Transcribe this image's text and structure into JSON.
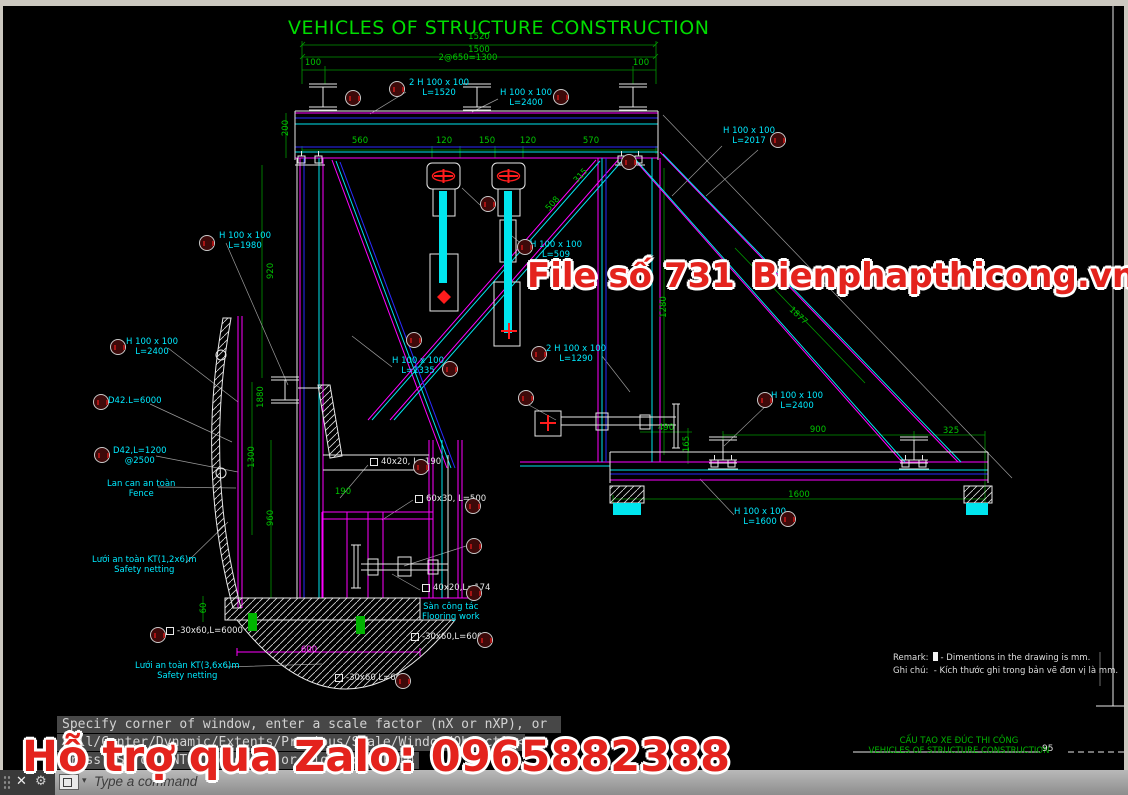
{
  "title": "VEHICLES OF STRUCTURE CONSTRUCTION",
  "watermarks": {
    "file_no": "File số 731",
    "site": "Bienphapthicong.vn",
    "zalo": "Hỗ trợ qua Zalo: 0965882388"
  },
  "remark": {
    "en_label": "Remark:",
    "en": "- Dimentions in the drawing is mm.",
    "vn_label": "Ghi chú:",
    "vn": "- Kích thước ghi trong bản vẽ đơn vị là mm."
  },
  "sheet_footer": {
    "title_vn": "CẤU TẠO XE ĐÚC THI CÔNG",
    "title_en": "VEHICLES OF STRUCTURE CONSTRUCTION",
    "page": "95"
  },
  "command_line": {
    "line1": "Specify corner of window, enter a scale factor (nX or nXP), or",
    "line2": "[All/Center/Dynamic/Extents/Previous/Scale/Window/Object] <real time>:",
    "line3": "Press ESC or ENTER to exit, or right-click to display shortcut menu.",
    "close_icon": "✕",
    "wrench_icon": "⚙",
    "caret_icon": "▾",
    "prompt": "Type a command"
  },
  "annotations": [
    {
      "x": 479,
      "y": 37,
      "c": "g",
      "ctr": 1,
      "lines": [
        "1520"
      ]
    },
    {
      "x": 479,
      "y": 50,
      "c": "g",
      "ctr": 1,
      "lines": [
        "1500"
      ]
    },
    {
      "x": 313,
      "y": 63,
      "c": "g",
      "ctr": 1,
      "lines": [
        "100"
      ]
    },
    {
      "x": 468,
      "y": 58,
      "c": "g",
      "ctr": 1,
      "lines": [
        "2@650=1300"
      ]
    },
    {
      "x": 641,
      "y": 63,
      "c": "g",
      "ctr": 1,
      "lines": [
        "100"
      ]
    },
    {
      "x": 286,
      "y": 128,
      "c": "g",
      "ctr": 1,
      "rot": -90,
      "lines": [
        "200"
      ]
    },
    {
      "x": 360,
      "y": 141,
      "c": "g",
      "ctr": 1,
      "lines": [
        "560"
      ]
    },
    {
      "x": 444,
      "y": 141,
      "c": "g",
      "ctr": 1,
      "lines": [
        "120"
      ]
    },
    {
      "x": 487,
      "y": 141,
      "c": "g",
      "ctr": 1,
      "lines": [
        "150"
      ]
    },
    {
      "x": 528,
      "y": 141,
      "c": "g",
      "ctr": 1,
      "lines": [
        "120"
      ]
    },
    {
      "x": 591,
      "y": 141,
      "c": "g",
      "ctr": 1,
      "lines": [
        "570"
      ]
    },
    {
      "x": 271,
      "y": 271,
      "c": "g",
      "ctr": 1,
      "rot": -90,
      "lines": [
        "920"
      ]
    },
    {
      "x": 261,
      "y": 397,
      "c": "g",
      "ctr": 1,
      "rot": -90,
      "lines": [
        "1880"
      ]
    },
    {
      "x": 252,
      "y": 457,
      "c": "g",
      "ctr": 1,
      "rot": -90,
      "lines": [
        "1300"
      ]
    },
    {
      "x": 271,
      "y": 518,
      "c": "g",
      "ctr": 1,
      "rot": -90,
      "lines": [
        "960"
      ]
    },
    {
      "x": 204,
      "y": 608,
      "c": "g",
      "ctr": 1,
      "rot": -90,
      "lines": [
        "60"
      ]
    },
    {
      "x": 343,
      "y": 492,
      "c": "g",
      "ctr": 1,
      "lines": [
        "190"
      ]
    },
    {
      "x": 581,
      "y": 176,
      "c": "g",
      "ctr": 1,
      "rot": -48,
      "lines": [
        "315"
      ]
    },
    {
      "x": 553,
      "y": 204,
      "c": "g",
      "ctr": 1,
      "rot": -48,
      "lines": [
        "508"
      ]
    },
    {
      "x": 664,
      "y": 307,
      "c": "g",
      "ctr": 1,
      "rot": -90,
      "lines": [
        "1280"
      ]
    },
    {
      "x": 798,
      "y": 316,
      "c": "g",
      "ctr": 1,
      "rot": 43,
      "lines": [
        "1877"
      ]
    },
    {
      "x": 666,
      "y": 428,
      "c": "g",
      "ctr": 1,
      "lines": [
        "490"
      ]
    },
    {
      "x": 687,
      "y": 444,
      "c": "g",
      "ctr": 1,
      "rot": -90,
      "lines": [
        "165"
      ]
    },
    {
      "x": 818,
      "y": 430,
      "c": "g",
      "ctr": 1,
      "lines": [
        "900"
      ]
    },
    {
      "x": 951,
      "y": 431,
      "c": "g",
      "ctr": 1,
      "lines": [
        "325"
      ]
    },
    {
      "x": 799,
      "y": 495,
      "c": "g",
      "ctr": 1,
      "lines": [
        "1600"
      ]
    },
    {
      "x": 309,
      "y": 650,
      "c": "m",
      "ctr": 1,
      "lines": [
        "600"
      ]
    },
    {
      "x": 409,
      "y": 78,
      "c": "c",
      "lines": [
        "2 H 100 x 100",
        "L=1520"
      ]
    },
    {
      "x": 500,
      "y": 88,
      "c": "c",
      "lines": [
        "H 100 x 100",
        "L=2400"
      ]
    },
    {
      "x": 723,
      "y": 126,
      "c": "c",
      "lines": [
        "H 100 x 100",
        "L=2017"
      ]
    },
    {
      "x": 530,
      "y": 240,
      "c": "c",
      "lines": [
        "H 100 x 100",
        "L=509"
      ]
    },
    {
      "x": 392,
      "y": 356,
      "c": "c",
      "lines": [
        "H 100 x 100",
        "L=1335"
      ]
    },
    {
      "x": 546,
      "y": 344,
      "c": "c",
      "lines": [
        "2 H 100 x 100",
        "L=1290"
      ]
    },
    {
      "x": 771,
      "y": 391,
      "c": "c",
      "lines": [
        "H 100 x 100",
        "L=2400"
      ]
    },
    {
      "x": 734,
      "y": 507,
      "c": "c",
      "lines": [
        "H 100 x 100",
        "L=1600"
      ]
    },
    {
      "x": 219,
      "y": 231,
      "c": "c",
      "lines": [
        "H 100 x 100",
        "L=1980"
      ]
    },
    {
      "x": 126,
      "y": 337,
      "c": "c",
      "lines": [
        "H 100 x 100",
        "L=2400"
      ]
    },
    {
      "x": 108,
      "y": 396,
      "c": "c",
      "lines": [
        "D42.L=6000"
      ]
    },
    {
      "x": 113,
      "y": 446,
      "c": "c",
      "lines": [
        "D42,L=1200",
        "@2500"
      ]
    },
    {
      "x": 107,
      "y": 479,
      "c": "c",
      "lines": [
        "Lan can an toàn",
        "Fence"
      ]
    },
    {
      "x": 92,
      "y": 555,
      "c": "c",
      "lines": [
        "Lưới an toàn KT(1,2x6)m",
        "Safety netting"
      ]
    },
    {
      "x": 422,
      "y": 602,
      "c": "c",
      "lines": [
        "Sàn công tác",
        "Flooring work"
      ]
    },
    {
      "x": 135,
      "y": 661,
      "c": "c",
      "lines": [
        "Lưới an toàn KT(3,6x6)m",
        "Safety netting"
      ]
    },
    {
      "x": 370,
      "y": 457,
      "c": "w",
      "sq": 1,
      "lines": [
        "40x20, L=190"
      ]
    },
    {
      "x": 415,
      "y": 494,
      "c": "w",
      "sq": 1,
      "lines": [
        "60x30, L=500"
      ]
    },
    {
      "x": 422,
      "y": 583,
      "c": "w",
      "sq": 1,
      "lines": [
        "40x20,L=174"
      ]
    },
    {
      "x": 166,
      "y": 626,
      "c": "w",
      "sq": 1,
      "lines": [
        "-30x60,L=6000"
      ]
    },
    {
      "x": 411,
      "y": 632,
      "c": "w",
      "sq": 1,
      "lines": [
        "-30x60,L=6000"
      ]
    },
    {
      "x": 335,
      "y": 673,
      "c": "w",
      "sq": 1,
      "lines": [
        "-30x60,L=600"
      ]
    }
  ],
  "balloons": [
    [
      353,
      98
    ],
    [
      397,
      89
    ],
    [
      561,
      97
    ],
    [
      629,
      162
    ],
    [
      778,
      140
    ],
    [
      488,
      204
    ],
    [
      525,
      247
    ],
    [
      414,
      340
    ],
    [
      450,
      369
    ],
    [
      539,
      354
    ],
    [
      526,
      398
    ],
    [
      765,
      400
    ],
    [
      788,
      519
    ],
    [
      207,
      243
    ],
    [
      118,
      347
    ],
    [
      101,
      402
    ],
    [
      102,
      455
    ],
    [
      421,
      467
    ],
    [
      473,
      506
    ],
    [
      474,
      546
    ],
    [
      474,
      593
    ],
    [
      158,
      635
    ],
    [
      485,
      640
    ],
    [
      403,
      681
    ]
  ]
}
